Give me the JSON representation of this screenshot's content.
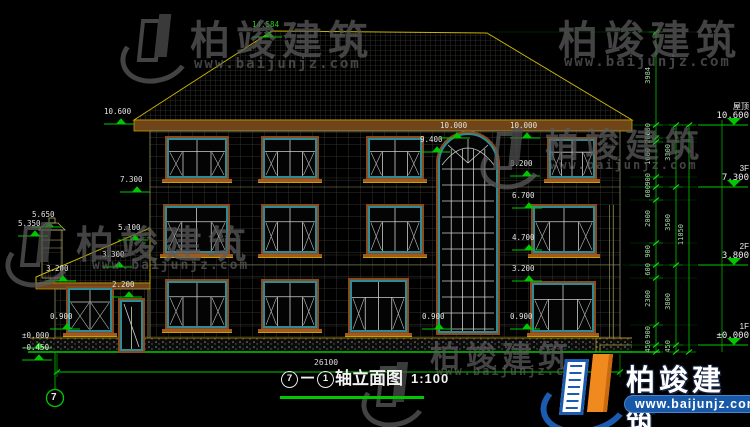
{
  "drawing_title": {
    "axis_start": "7",
    "dash": "－",
    "axis_end": "1",
    "name": "轴立面图",
    "scale": "1:100"
  },
  "bottom_dimension": "26100",
  "axis_bubble": "7",
  "watermark": {
    "company": "柏竣建筑",
    "url": "www.baijunjz.com"
  },
  "brand_logo": {
    "company": "柏竣建筑",
    "url": "www.baijunjz.com"
  },
  "colors": {
    "dim_green": "#00c800",
    "cad_yellow": "#c8b400",
    "frame_teal": "#2e8b96",
    "surround_brown": "#8a4a1c",
    "logo_blue": "#1b5bb0",
    "logo_orange": "#f08a1e"
  },
  "right_levels": [
    {
      "label": "屋顶",
      "value": "10.600",
      "y": 125
    },
    {
      "label": "3F",
      "value": "7.300",
      "y": 187
    },
    {
      "label": "2F",
      "value": "3.800",
      "y": 265
    },
    {
      "label": "1F",
      "value": "±0.000",
      "y": 345
    }
  ],
  "elevation_marks": [
    {
      "text": "14.584",
      "x": 252,
      "y": 21,
      "green": true
    },
    {
      "text": "10.600",
      "x": 104,
      "y": 108
    },
    {
      "text": "7.300",
      "x": 120,
      "y": 176
    },
    {
      "text": "5.650",
      "x": 32,
      "y": 211
    },
    {
      "text": "5.350",
      "x": 18,
      "y": 220
    },
    {
      "text": "5.100",
      "x": 118,
      "y": 224
    },
    {
      "text": "3.300",
      "x": 102,
      "y": 251
    },
    {
      "text": "3.200",
      "x": 46,
      "y": 265
    },
    {
      "text": "2.200",
      "x": 112,
      "y": 281
    },
    {
      "text": "0.900",
      "x": 50,
      "y": 313
    },
    {
      "text": "±0.000",
      "x": 22,
      "y": 332
    },
    {
      "text": "-0.450",
      "x": 22,
      "y": 344
    },
    {
      "text": "9.400",
      "x": 420,
      "y": 136
    },
    {
      "text": "10.000",
      "x": 440,
      "y": 122
    },
    {
      "text": "10.000",
      "x": 510,
      "y": 122
    },
    {
      "text": "8.200",
      "x": 510,
      "y": 160
    },
    {
      "text": "6.700",
      "x": 512,
      "y": 192
    },
    {
      "text": "4.700",
      "x": 512,
      "y": 234
    },
    {
      "text": "3.200",
      "x": 512,
      "y": 265
    },
    {
      "text": "0.900",
      "x": 422,
      "y": 313
    },
    {
      "text": "0.900",
      "x": 510,
      "y": 313
    }
  ],
  "dim_chains": [
    {
      "x": 656,
      "ticks": [
        32,
        125,
        138,
        142,
        177,
        187,
        200,
        243,
        265,
        278,
        325,
        345,
        352
      ],
      "labels": [
        "3984",
        "600",
        "200",
        "1600",
        "900",
        "600",
        "2000",
        "900",
        "600",
        "2300",
        "900",
        "450"
      ]
    },
    {
      "x": 676,
      "ticks": [
        125,
        187,
        265,
        345,
        352
      ],
      "labels": [
        "3300",
        "3500",
        "3800",
        "450"
      ]
    },
    {
      "x": 689,
      "ticks": [
        125,
        352
      ],
      "labels": [
        "11050"
      ]
    }
  ],
  "windows": [
    {
      "x": 167,
      "y": 138,
      "w": 60,
      "h": 40,
      "kind": "std"
    },
    {
      "x": 263,
      "y": 138,
      "w": 54,
      "h": 40,
      "kind": "std"
    },
    {
      "x": 368,
      "y": 138,
      "w": 54,
      "h": 40,
      "kind": "std"
    },
    {
      "x": 549,
      "y": 139,
      "w": 46,
      "h": 39,
      "kind": "std"
    },
    {
      "x": 165,
      "y": 206,
      "w": 63,
      "h": 47,
      "kind": "std"
    },
    {
      "x": 263,
      "y": 206,
      "w": 54,
      "h": 47,
      "kind": "std"
    },
    {
      "x": 368,
      "y": 206,
      "w": 54,
      "h": 47,
      "kind": "std"
    },
    {
      "x": 533,
      "y": 206,
      "w": 62,
      "h": 47,
      "kind": "std"
    },
    {
      "x": 167,
      "y": 281,
      "w": 60,
      "h": 47,
      "kind": "std"
    },
    {
      "x": 263,
      "y": 281,
      "w": 54,
      "h": 47,
      "kind": "std"
    },
    {
      "x": 350,
      "y": 280,
      "w": 57,
      "h": 52,
      "kind": "std"
    },
    {
      "x": 532,
      "y": 283,
      "w": 62,
      "h": 49,
      "kind": "std"
    },
    {
      "x": 68,
      "y": 288,
      "w": 44,
      "h": 44,
      "kind": "small"
    },
    {
      "x": 438,
      "y": 133,
      "w": 60,
      "h": 200,
      "kind": "arch"
    },
    {
      "x": 120,
      "y": 300,
      "w": 23,
      "h": 51,
      "kind": "door"
    }
  ],
  "watermark_instances": [
    {
      "logo": true,
      "lx": 128,
      "ly": 14,
      "ls": 54,
      "tx": 190,
      "ty": 8,
      "ts": 40,
      "ux": 194,
      "uy": 56,
      "us": 14
    },
    {
      "logo": false,
      "lx": 0,
      "ly": 0,
      "ls": 0,
      "tx": 558,
      "ty": 8,
      "ts": 40,
      "ux": 564,
      "uy": 54,
      "us": 14
    },
    {
      "logo": true,
      "lx": 486,
      "ly": 128,
      "ls": 46,
      "tx": 545,
      "ty": 118,
      "ts": 34,
      "ux": 550,
      "uy": 158,
      "us": 12
    },
    {
      "logo": true,
      "lx": 12,
      "ly": 222,
      "ls": 50,
      "tx": 76,
      "ty": 214,
      "ts": 38,
      "ux": 92,
      "uy": 258,
      "us": 13
    },
    {
      "logo": true,
      "lx": 368,
      "ly": 362,
      "ls": 50,
      "tx": 430,
      "ty": 332,
      "ts": 30,
      "ux": 436,
      "uy": 364,
      "us": 12
    }
  ]
}
